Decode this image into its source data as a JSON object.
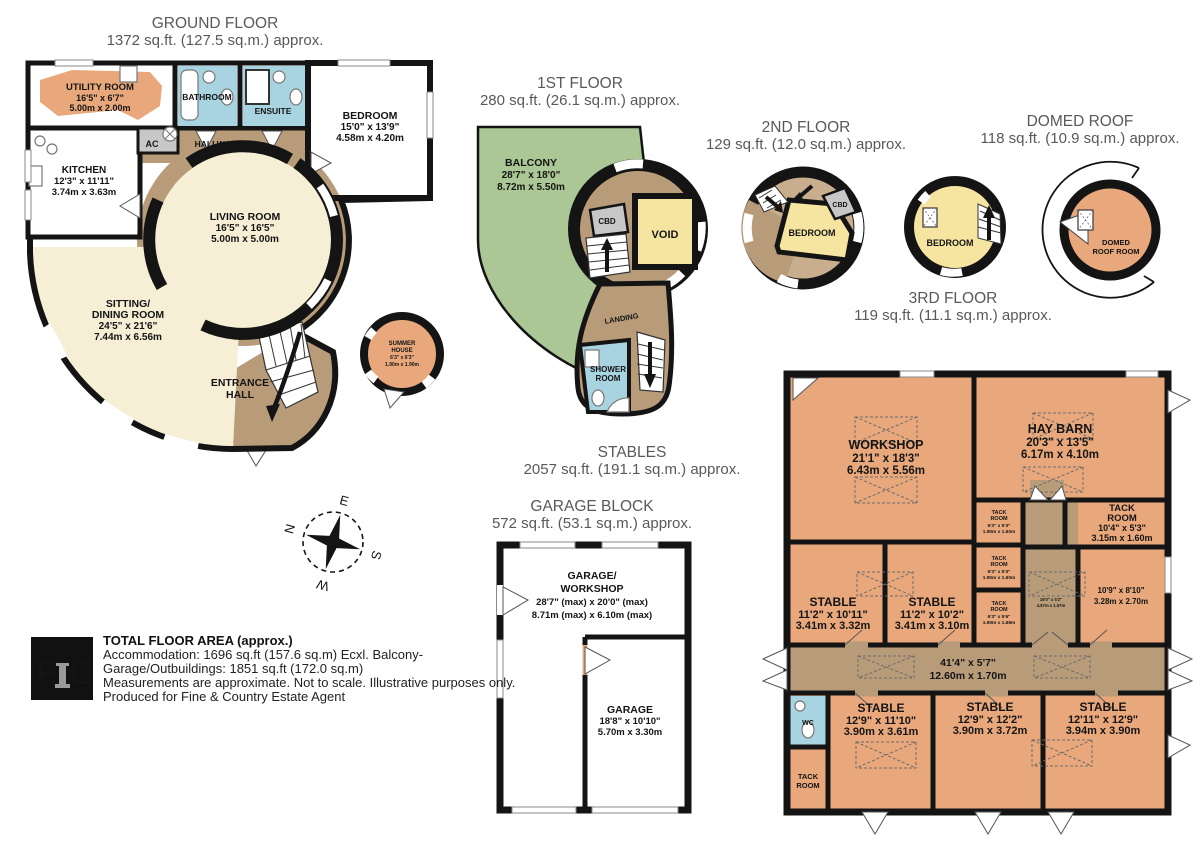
{
  "titles": {
    "ground": {
      "name": "GROUND FLOOR",
      "area": "1372 sq.ft. (127.5 sq.m.) approx."
    },
    "first": {
      "name": "1ST FLOOR",
      "area": "280 sq.ft. (26.1 sq.m.) approx."
    },
    "second": {
      "name": "2ND FLOOR",
      "area": "129 sq.ft. (12.0 sq.m.) approx."
    },
    "third": {
      "name": "3RD FLOOR",
      "area": "119 sq.ft. (11.1 sq.m.) approx."
    },
    "domed": {
      "name": "DOMED ROOF",
      "area": "118 sq.ft. (10.9 sq.m.) approx."
    },
    "stables": {
      "name": "STABLES",
      "area": "2057 sq.ft. (191.1 sq.m.) approx."
    },
    "garage": {
      "name": "GARAGE BLOCK",
      "area": "572 sq.ft. (53.1 sq.m.) approx."
    }
  },
  "g": {
    "utility": [
      "UTILITY ROOM",
      "16'5\" x 6'7\"",
      "5.00m x 2.00m"
    ],
    "bathroom": "BATHROOM",
    "ensuite": "ENSUITE",
    "bedroom": [
      "BEDROOM",
      "15'0\" x 13'9\"",
      "4.58m x 4.20m"
    ],
    "kitchen": [
      "KITCHEN",
      "12'3\" x 11'11\"",
      "3.74m x 3.63m"
    ],
    "ac": "AC",
    "hallway": "HALLWAY",
    "living": [
      "LIVING ROOM",
      "16'5\" x 16'5\"",
      "5.00m x 5.00m"
    ],
    "sitting": [
      "SITTING/",
      "DINING ROOM",
      "24'5\" x 21'6\"",
      "7.44m x 6.56m"
    ],
    "entrance": [
      "ENTRANCE",
      "HALL"
    ],
    "summer": [
      "SUMMER",
      "HOUSE",
      "6'3\" x 6'3\"",
      "1.90m x 1.90m"
    ]
  },
  "f1": {
    "balcony": [
      "BALCONY",
      "28'7\" x 18'0\"",
      "8.72m x 5.50m"
    ],
    "cbd": "CBD",
    "void": "VOID",
    "landing": "LANDING",
    "shower": [
      "SHOWER",
      "ROOM"
    ]
  },
  "f2": {
    "bedroom": "BEDROOM",
    "cbd": "CBD"
  },
  "f3": {
    "bedroom": "BEDROOM"
  },
  "dome": {
    "room": [
      "DOMED",
      "ROOF ROOM"
    ]
  },
  "st": {
    "workshop": [
      "WORKSHOP",
      "21'1\" x 18'3\"",
      "6.43m x 5.56m"
    ],
    "hay": [
      "HAY BARN",
      "20'3\" x 13'5\"",
      "6.17m x 4.10m"
    ],
    "tack1": [
      "TACK",
      "ROOM",
      "6'3\" x 5'3\"",
      "1.90m x 1.60m"
    ],
    "tackr": [
      "TACK",
      "ROOM",
      "10'4\" x 5'3\"",
      "3.15m x 1.60m"
    ],
    "tack2": [
      "TACK",
      "ROOM",
      "6'3\" x 5'3\"",
      "1.90m x 1.60m"
    ],
    "tack3": [
      "TACK",
      "ROOM",
      "6'3\" x 5'6\"",
      "1.90m x 1.68m"
    ],
    "r109": [
      "10'9\" x 8'10\"",
      "3.28m x 2.70m"
    ],
    "pass": [
      "16'0\" x 5'2\"",
      "4.87m x 1.57m"
    ],
    "s1": [
      "STABLE",
      "11'2\" x 10'11\"",
      "3.41m x 3.32m"
    ],
    "s2": [
      "STABLE",
      "11'2\" x 10'2\"",
      "3.41m x 3.10m"
    ],
    "corr": [
      "41'4\" x 5'7\"",
      "12.60m x 1.70m"
    ],
    "wc": "WC",
    "tackb": [
      "TACK",
      "ROOM"
    ],
    "s3": [
      "STABLE",
      "12'9\" x 11'10\"",
      "3.90m x 3.61m"
    ],
    "s4": [
      "STABLE",
      "12'9\" x 12'2\"",
      "3.90m x 3.72m"
    ],
    "s5": [
      "STABLE",
      "12'11\" x 12'9\"",
      "3.94m x 3.90m"
    ]
  },
  "gb": {
    "gw": [
      "GARAGE/",
      "WORKSHOP",
      "28'7\" (max) x 20'0\" (max)",
      "8.71m (max) x 6.10m (max)"
    ],
    "garage": [
      "GARAGE",
      "18'8\" x 10'10\"",
      "5.70m x 3.30m"
    ]
  },
  "compass": {
    "n": "N",
    "e": "E",
    "s": "S",
    "w": "W"
  },
  "footer": {
    "title": "TOTAL FLOOR AREA (approx.)",
    "line1": "Accommodation: 1696 sq.ft (157.6 sq.m) Ecxl. Balcony-",
    "line2": "Garage/Outbuildings: 1851 sq.ft (172.0 sq.m)",
    "line3": "Measurements are approximate. Not to scale. Illustrative purposes only.",
    "line4": "Produced for Fine & Country Estate Agent"
  },
  "logo": {
    "f": "F",
    "amp": "&",
    "c": "C",
    "url": "fineandcountry.com™"
  },
  "colors": {
    "wall": "#141414",
    "cream": "#F6EFD6",
    "yellow": "#F5E5A1",
    "orange": "#E9A87C",
    "blue": "#A8D4E2",
    "brown": "#B89C79",
    "brown_light": "#C9AE8E",
    "green": "#AAC795",
    "gray": "#C7C7C7",
    "kitchen": "#EBEDE3",
    "title_gray": "#58595B",
    "logo_gold": "#C9B27A"
  }
}
